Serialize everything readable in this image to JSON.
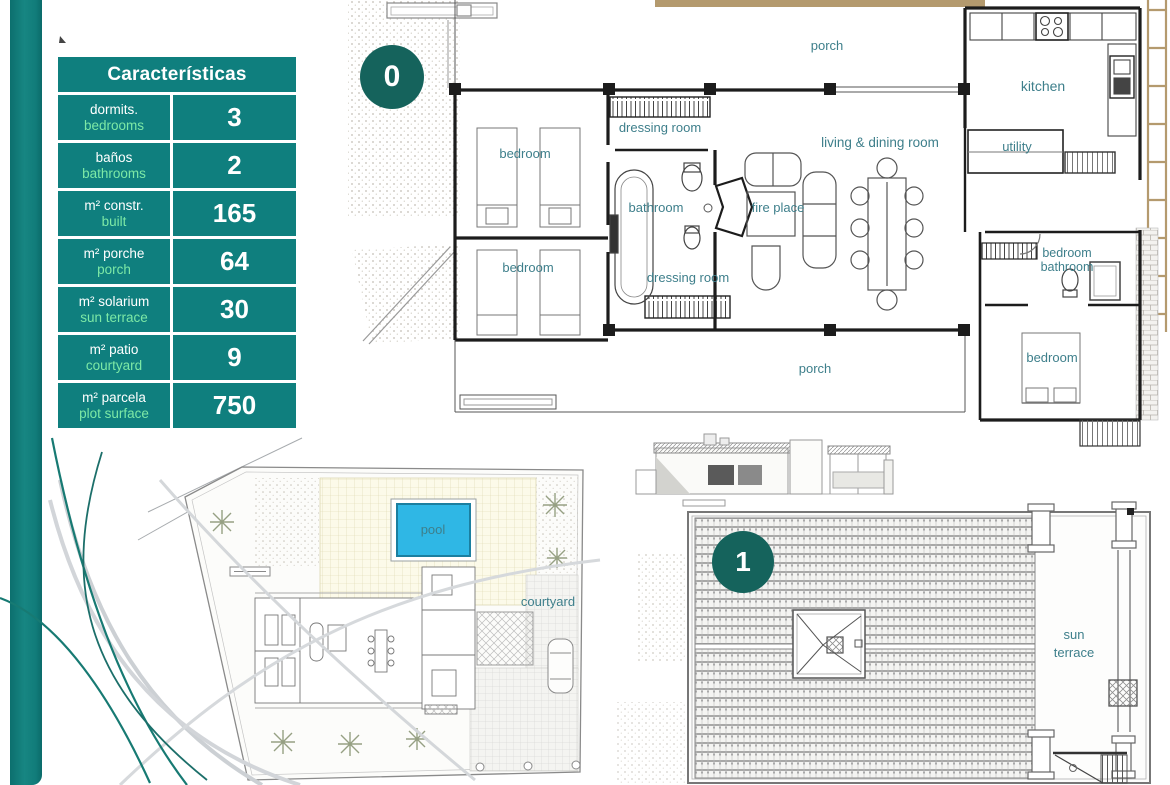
{
  "colors": {
    "table_teal": "#0f7f7e",
    "badge_teal": "#15635c",
    "mint_green": "#7de9a6",
    "plan_label_teal": "#3e7f8b",
    "pool_cyan": "#2fb7e5",
    "pergola_tan": "#b49a6e"
  },
  "table": {
    "title": "Características",
    "rows": [
      {
        "es": "dormits.",
        "en": "bedrooms",
        "value": "3"
      },
      {
        "es": "baños",
        "en": "bathrooms",
        "value": "2"
      },
      {
        "es": "m² constr.",
        "en": "built",
        "value": "165"
      },
      {
        "es": "m² porche",
        "en": "porch",
        "value": "64"
      },
      {
        "es": "m² solarium",
        "en": "sun terrace",
        "value": "30"
      },
      {
        "es": "m² patio",
        "en": "courtyard",
        "value": "9"
      },
      {
        "es": "m² parcela",
        "en": "plot surface",
        "value": "750"
      }
    ]
  },
  "floor_plan": {
    "badge": "0",
    "labels": {
      "porch_top": "porch",
      "kitchen": "kitchen",
      "dressing_room_top": "dressing room",
      "living_dining": "living & dining room",
      "bedroom_top": "bedroom",
      "bathroom": "bathroom",
      "fire_place": "fire place",
      "utility": "utility",
      "bedroom_mid": "bedroom",
      "dressing_room_bottom": "dressing room",
      "bedroom_bath_line1": "bedroom",
      "bedroom_bath_line2": "bathroom",
      "bedroom_right": "bedroom",
      "porch_bottom": "porch"
    }
  },
  "site_plan": {
    "pool": "pool",
    "courtyard": "courtyard"
  },
  "roof_plan": {
    "badge": "1",
    "sun_terrace_line1": "sun",
    "sun_terrace_line2": "terrace"
  }
}
